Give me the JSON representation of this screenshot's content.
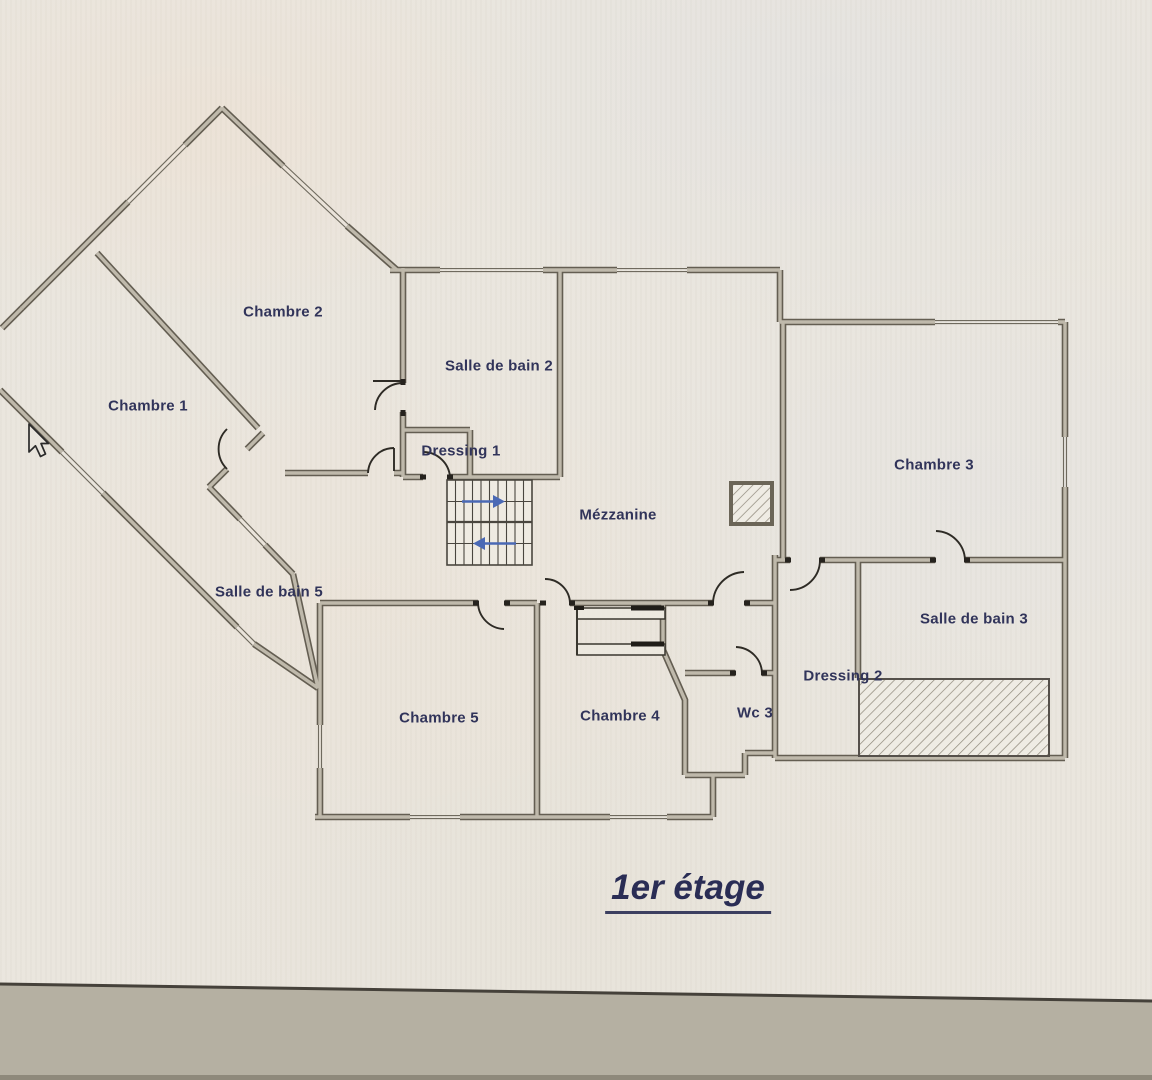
{
  "plan": {
    "title": "1er étage",
    "rooms": [
      {
        "id": "chambre-1",
        "label": "Chambre 1"
      },
      {
        "id": "chambre-2",
        "label": "Chambre 2"
      },
      {
        "id": "salle-de-bain-2",
        "label": "Salle de bain 2"
      },
      {
        "id": "dressing-1",
        "label": "Dressing 1"
      },
      {
        "id": "mezzanine",
        "label": "Mézzanine"
      },
      {
        "id": "chambre-3",
        "label": "Chambre 3"
      },
      {
        "id": "salle-de-bain-5",
        "label": "Salle de bain 5"
      },
      {
        "id": "salle-de-bain-3",
        "label": "Salle de bain 3"
      },
      {
        "id": "dressing-2",
        "label": "Dressing 2"
      },
      {
        "id": "wc-3",
        "label": "Wc 3"
      },
      {
        "id": "chambre-4",
        "label": "Chambre 4"
      },
      {
        "id": "chambre-5",
        "label": "Chambre 5"
      }
    ],
    "stairs": {
      "flights": 2
    },
    "colors": {
      "paper": "#eae6de",
      "wall_edge": "#645e52",
      "wall_fill": "#bfb9ab",
      "label_text": "#31345a",
      "title_text": "#2a2d55",
      "stair_arrow": "#4a69b5",
      "hatch_line": "#8d8779",
      "desk_band": "#b5b0a2"
    },
    "cursor_visible": true
  }
}
